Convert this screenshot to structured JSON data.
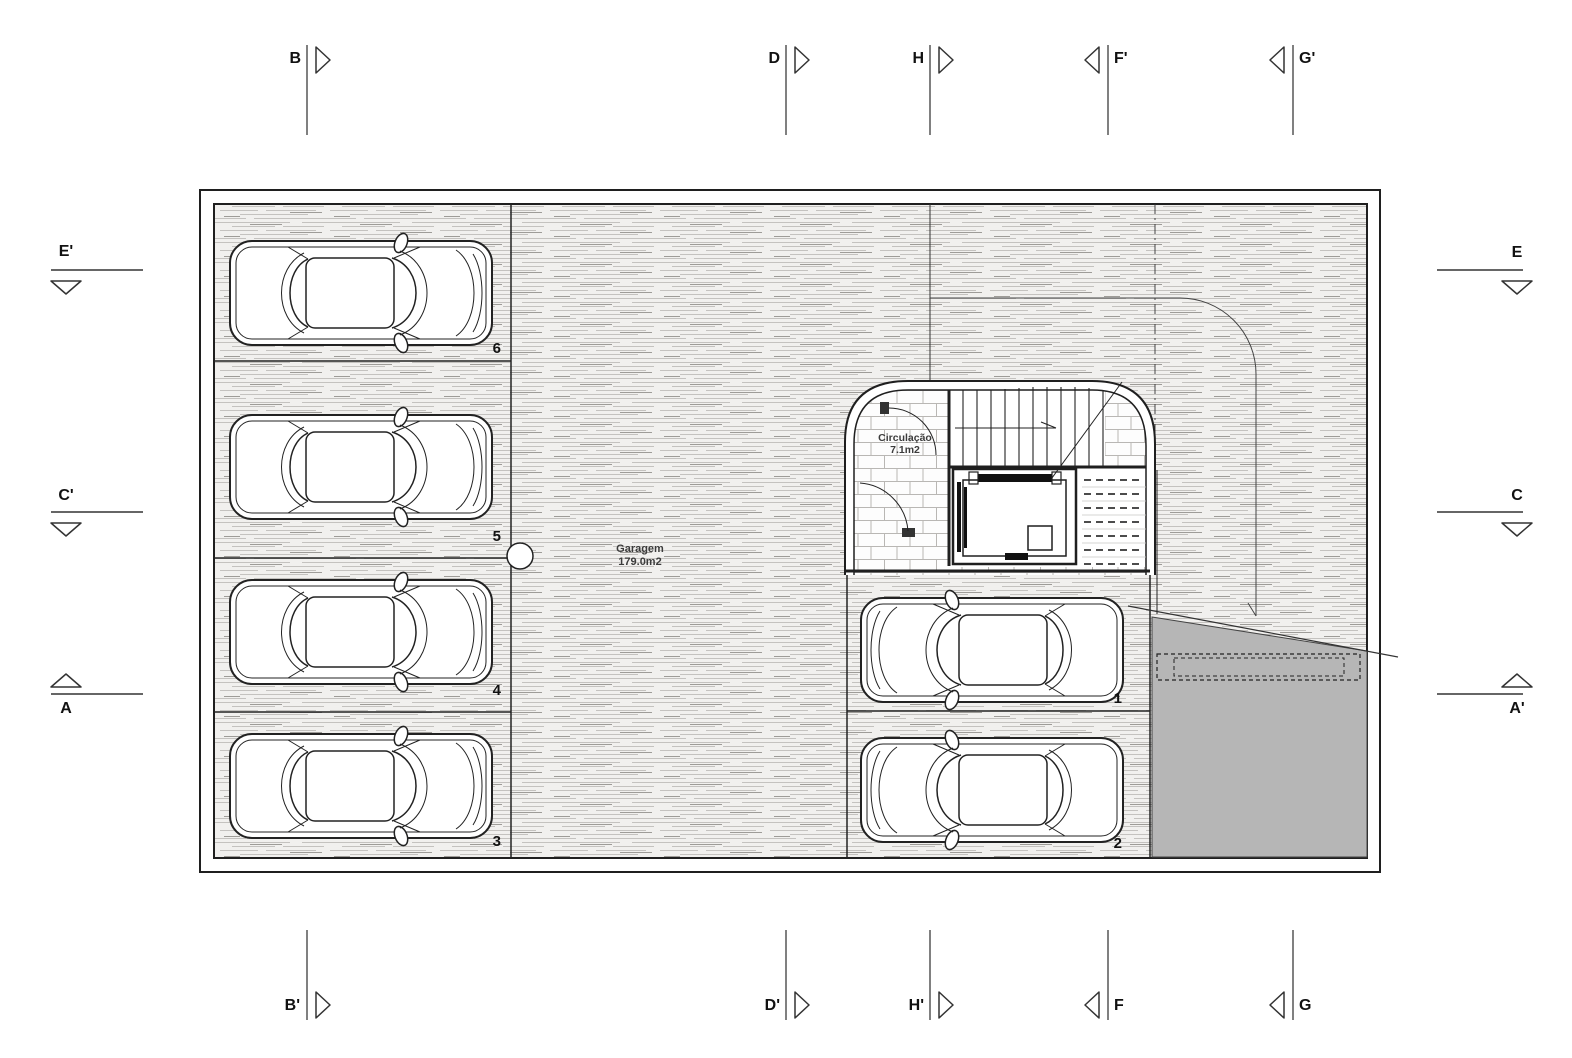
{
  "drawing_type": "garage-floor-plan",
  "rooms": {
    "garage": {
      "name": "Garagem",
      "area": "179.0m2"
    },
    "circulation": {
      "name": "Circulação",
      "area": "7.1m2"
    }
  },
  "parking": {
    "spots": [
      {
        "number": "6"
      },
      {
        "number": "5"
      },
      {
        "number": "4"
      },
      {
        "number": "3"
      },
      {
        "number": "1"
      },
      {
        "number": "2"
      }
    ]
  },
  "section_markers": {
    "top": [
      {
        "label": "B"
      },
      {
        "label": "D"
      },
      {
        "label": "H"
      },
      {
        "label": "F'"
      },
      {
        "label": "G'"
      }
    ],
    "bottom": [
      {
        "label": "B'"
      },
      {
        "label": "D'"
      },
      {
        "label": "H'"
      },
      {
        "label": "F"
      },
      {
        "label": "G"
      }
    ],
    "left": [
      {
        "label": "E'"
      },
      {
        "label": "C'"
      },
      {
        "label": "A"
      }
    ],
    "right": [
      {
        "label": "E"
      },
      {
        "label": "C"
      },
      {
        "label": "A'"
      }
    ]
  },
  "colors": {
    "wall_line": "#1f1f1f",
    "thin_line": "#333333",
    "ramp_fill": "#b6b6b6",
    "floor_streak": "#c4c2bf",
    "tile_joint": "#b9b7b4"
  }
}
